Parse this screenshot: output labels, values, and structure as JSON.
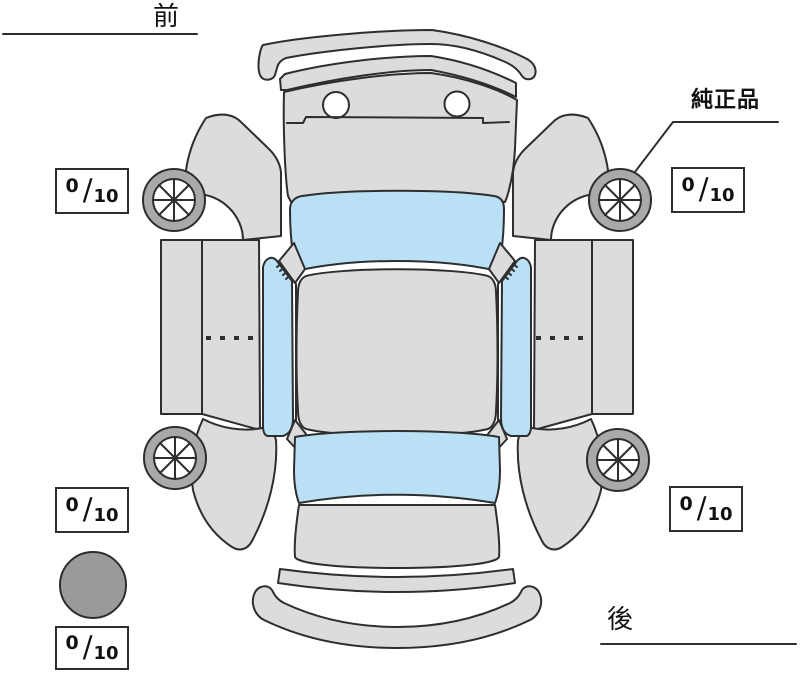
{
  "diagram": {
    "title_semantic": "vehicle-inspection-top-view",
    "front_label": "前",
    "rear_label": "後",
    "genuine_part_label": "純正品",
    "fraction_slash": "/",
    "tread_depth": {
      "front_left": {
        "value": "0",
        "max": "10"
      },
      "front_right": {
        "value": "0",
        "max": "10"
      },
      "rear_left": {
        "value": "0",
        "max": "10"
      },
      "rear_right": {
        "value": "0",
        "max": "10"
      },
      "spare": {
        "value": "0",
        "max": "10"
      }
    },
    "colors": {
      "body": "#dcdcdc",
      "glass": "#b9e0f5",
      "tire_ring": "#a9a9a9",
      "spare_tire": "#9a9a9a",
      "outline": "#2e2e2e",
      "background": "#ffffff"
    }
  }
}
